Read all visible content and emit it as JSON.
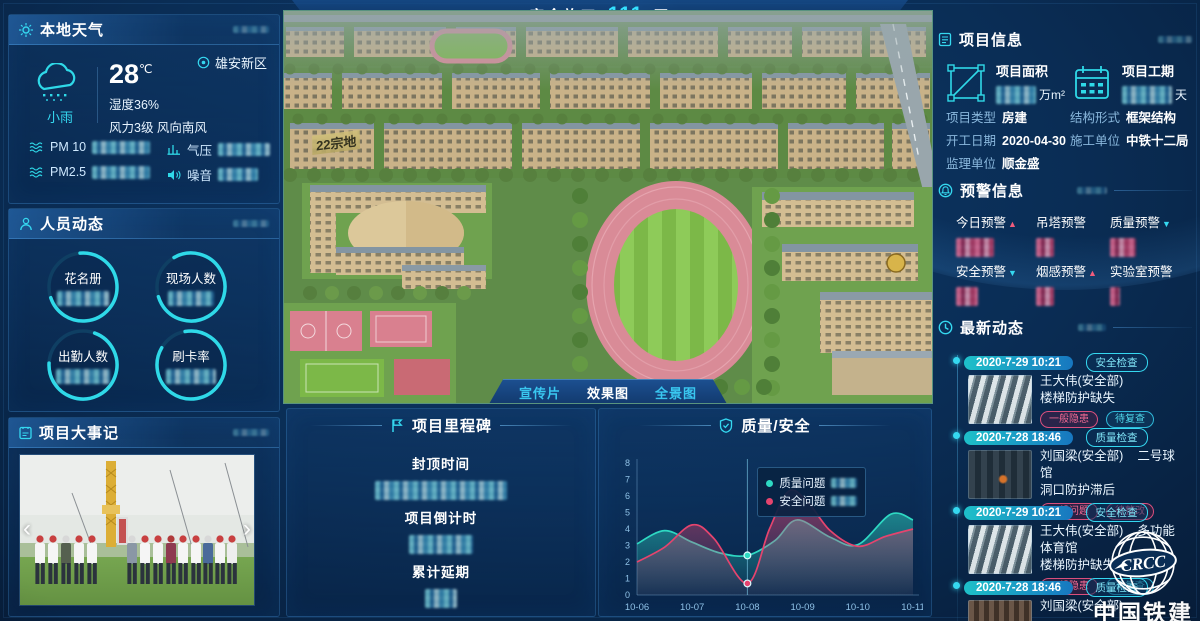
{
  "page": {
    "bg": "#0a2d55",
    "accent": "#35d8f0",
    "accent_pink": "#e5446e"
  },
  "header": {
    "prefix": "安全施工",
    "days": "111",
    "suffix": "天"
  },
  "weather": {
    "title": "本地天气",
    "location": "雄安新区",
    "condition": "小雨",
    "temp": "28",
    "temp_unit": "℃",
    "humidity": "湿度36%",
    "wind": "风力3级 风向南风",
    "metrics": [
      {
        "label": "PM 10"
      },
      {
        "label": "气压"
      },
      {
        "label": "PM2.5"
      },
      {
        "label": "噪音"
      }
    ]
  },
  "personnel": {
    "title": "人员动态",
    "rings": [
      {
        "label": "花名册"
      },
      {
        "label": "现场人数"
      },
      {
        "label": "出勤人数"
      },
      {
        "label": "刷卡率"
      }
    ]
  },
  "events": {
    "title": "项目大事记",
    "prev": "‹",
    "next": "›"
  },
  "scene": {
    "parcel": "22宗地",
    "buttons": [
      {
        "label": "宣传片"
      },
      {
        "label": "效果图"
      },
      {
        "label": "全景图"
      }
    ]
  },
  "milestone": {
    "title": "项目里程碑",
    "items": [
      {
        "label": "封顶时间"
      },
      {
        "label": "项目倒计时"
      },
      {
        "label": "累计延期"
      }
    ]
  },
  "quality": {
    "title": "质量/安全"
  },
  "chart_data": {
    "type": "area",
    "title": "质量/安全",
    "x_ticks": [
      "10-06",
      "10-07",
      "10-08",
      "10-09",
      "10-10",
      "10-11"
    ],
    "ylim": [
      0,
      8
    ],
    "y_ticks": [
      0,
      1,
      2,
      3,
      4,
      5,
      6,
      7,
      8
    ],
    "grid": false,
    "legend_position": "tooltip-at-10-08",
    "series": [
      {
        "name": "质量问题",
        "color": "#2ed9c3",
        "points": [
          [
            0,
            3.1
          ],
          [
            0.5,
            3.9
          ],
          [
            1,
            3.2
          ],
          [
            1.5,
            2.55
          ],
          [
            2,
            2.4
          ],
          [
            2.5,
            3.3
          ],
          [
            2.9,
            4.55
          ],
          [
            3.5,
            3.5
          ],
          [
            4,
            3.05
          ],
          [
            4.6,
            4.9
          ],
          [
            5,
            4.55
          ]
        ]
      },
      {
        "name": "安全问题",
        "color": "#e5446e",
        "points": [
          [
            0,
            2.0
          ],
          [
            0.5,
            2.9
          ],
          [
            1,
            4.25
          ],
          [
            1.4,
            3.4
          ],
          [
            2,
            0.7
          ],
          [
            2.4,
            4.0
          ],
          [
            2.75,
            6.3
          ],
          [
            3.1,
            5.6
          ],
          [
            3.5,
            3.9
          ],
          [
            4,
            2.95
          ],
          [
            4.5,
            3.55
          ],
          [
            5,
            4.0
          ]
        ]
      }
    ],
    "highlight": {
      "x": 2,
      "x_label": "10-08",
      "values": [
        2.4,
        0.7
      ]
    }
  },
  "info": {
    "title": "项目信息",
    "stats": [
      {
        "label": "项目面积",
        "unit": "万m²"
      },
      {
        "label": "项目工期",
        "unit": "天"
      }
    ],
    "fields": [
      {
        "label": "项目类型",
        "value": "房建"
      },
      {
        "label": "结构形式",
        "value": "框架结构"
      },
      {
        "label": "开工日期",
        "value": "2020-04-30"
      },
      {
        "label": "施工单位",
        "value": "中铁十二局"
      },
      {
        "label": "监理单位",
        "value": "顺金盛"
      }
    ]
  },
  "alerts": {
    "title": "预警信息",
    "items": [
      {
        "label": "今日预警",
        "trend": "▲",
        "trend_color": "#f25c7c"
      },
      {
        "label": "吊塔预警",
        "trend": "",
        "trend_color": ""
      },
      {
        "label": "质量预警",
        "trend": "▼",
        "trend_color": "#35d8f0"
      },
      {
        "label": "安全预警",
        "trend": "▼",
        "trend_color": "#35d8f0"
      },
      {
        "label": "烟感预警",
        "trend": "▲",
        "trend_color": "#f25c7c"
      },
      {
        "label": "实验室预警",
        "trend": "",
        "trend_color": ""
      }
    ]
  },
  "feed": {
    "title": "最新动态",
    "entries": [
      {
        "date": "2020-7-29 10:21",
        "type": "安全检查",
        "person": "王大伟(安全部)",
        "location": "",
        "issue": "楼梯防护缺失",
        "tag1": "一般隐患",
        "tag2": "待复查"
      },
      {
        "date": "2020-7-28 18:46",
        "type": "质量检查",
        "person": "刘国梁(安全部)",
        "location": "二号球馆",
        "issue": "洞口防护滞后",
        "tag1": "一般问题",
        "tag2": "待整改"
      },
      {
        "date": "2020-7-29 10:21",
        "type": "安全检查",
        "person": "王大伟(安全部)",
        "location": "多功能体育馆",
        "issue": "楼梯防护缺失",
        "tag1": "一般隐患",
        "tag2": "待复查"
      },
      {
        "date": "2020-7-28 18:46",
        "type": "质量检查",
        "person": "刘国梁(安全部)",
        "location": "",
        "issue": "",
        "tag1": "",
        "tag2": ""
      }
    ]
  },
  "logo": {
    "brand": "CRCC",
    "name": "中国铁建"
  }
}
